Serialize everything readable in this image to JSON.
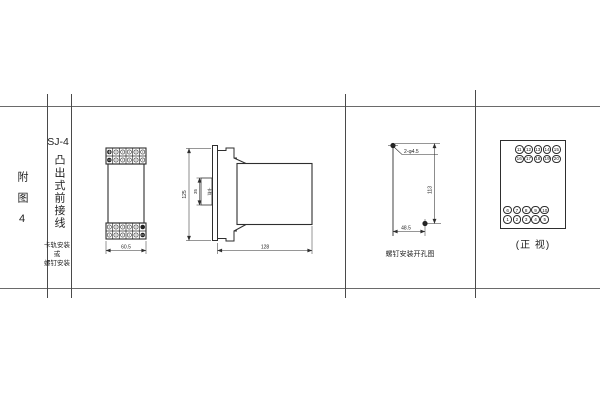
{
  "sidebar": {
    "figure_label": "附图4",
    "model": "SJ-4",
    "type_label": "凸出式前接线",
    "mount_lines": [
      "卡轨安装",
      "或",
      "螺钉安装"
    ]
  },
  "front_view": {
    "width_dim": "60.5"
  },
  "side_view": {
    "height_dim": "125",
    "rail_dim": "35",
    "rail_label": "卡轨",
    "depth_dim": "128"
  },
  "drill_view": {
    "hole_label": "2-φ4.5",
    "vertical_dim": "113",
    "horizontal_dim": "48.5",
    "caption": "螺钉安装开孔图"
  },
  "terminal_panel": {
    "caption": "(正 视)",
    "top_rows": [
      [
        "11",
        "12",
        "13",
        "14",
        "15"
      ],
      [
        "16",
        "17",
        "18",
        "19",
        "20"
      ]
    ],
    "bottom_rows": [
      [
        "6",
        "7",
        "8",
        "9",
        "10"
      ],
      [
        "1",
        "2",
        "3",
        "4",
        "5"
      ]
    ]
  },
  "colors": {
    "line": "#2e2e2e",
    "rule": "#6a6a6a"
  }
}
